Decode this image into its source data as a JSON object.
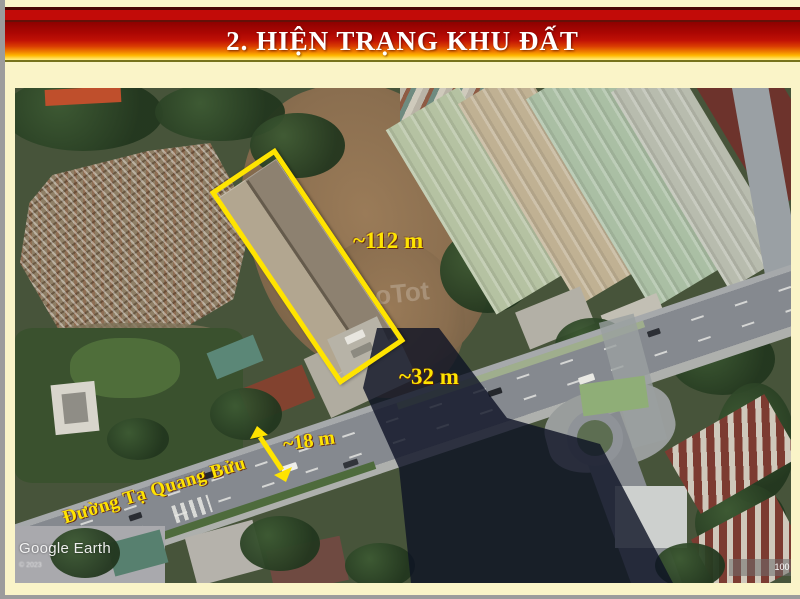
{
  "slide": {
    "title": "2. HIỆN TRẠNG KHU ĐẤT",
    "colors": {
      "background_cream": "#FAF4C8",
      "banner_red_dark": "#8E0100",
      "banner_red": "#C01105",
      "banner_orange": "#EF7E00",
      "banner_yellow": "#FFEC82",
      "title_text": "#FFFFFF",
      "annotation_yellow": "#FFE400",
      "frame_grey": "#9C9C9C"
    }
  },
  "map": {
    "annotations": {
      "length_label": "~112 m",
      "width_label": "~32 m",
      "road_width_label": "~18 m",
      "street_name": "Đường Tạ Quang Bửu"
    },
    "watermarks": {
      "provider": "Google Earth",
      "copyright": "© 2023",
      "scale": "100 ft",
      "faint": "oTot"
    }
  }
}
